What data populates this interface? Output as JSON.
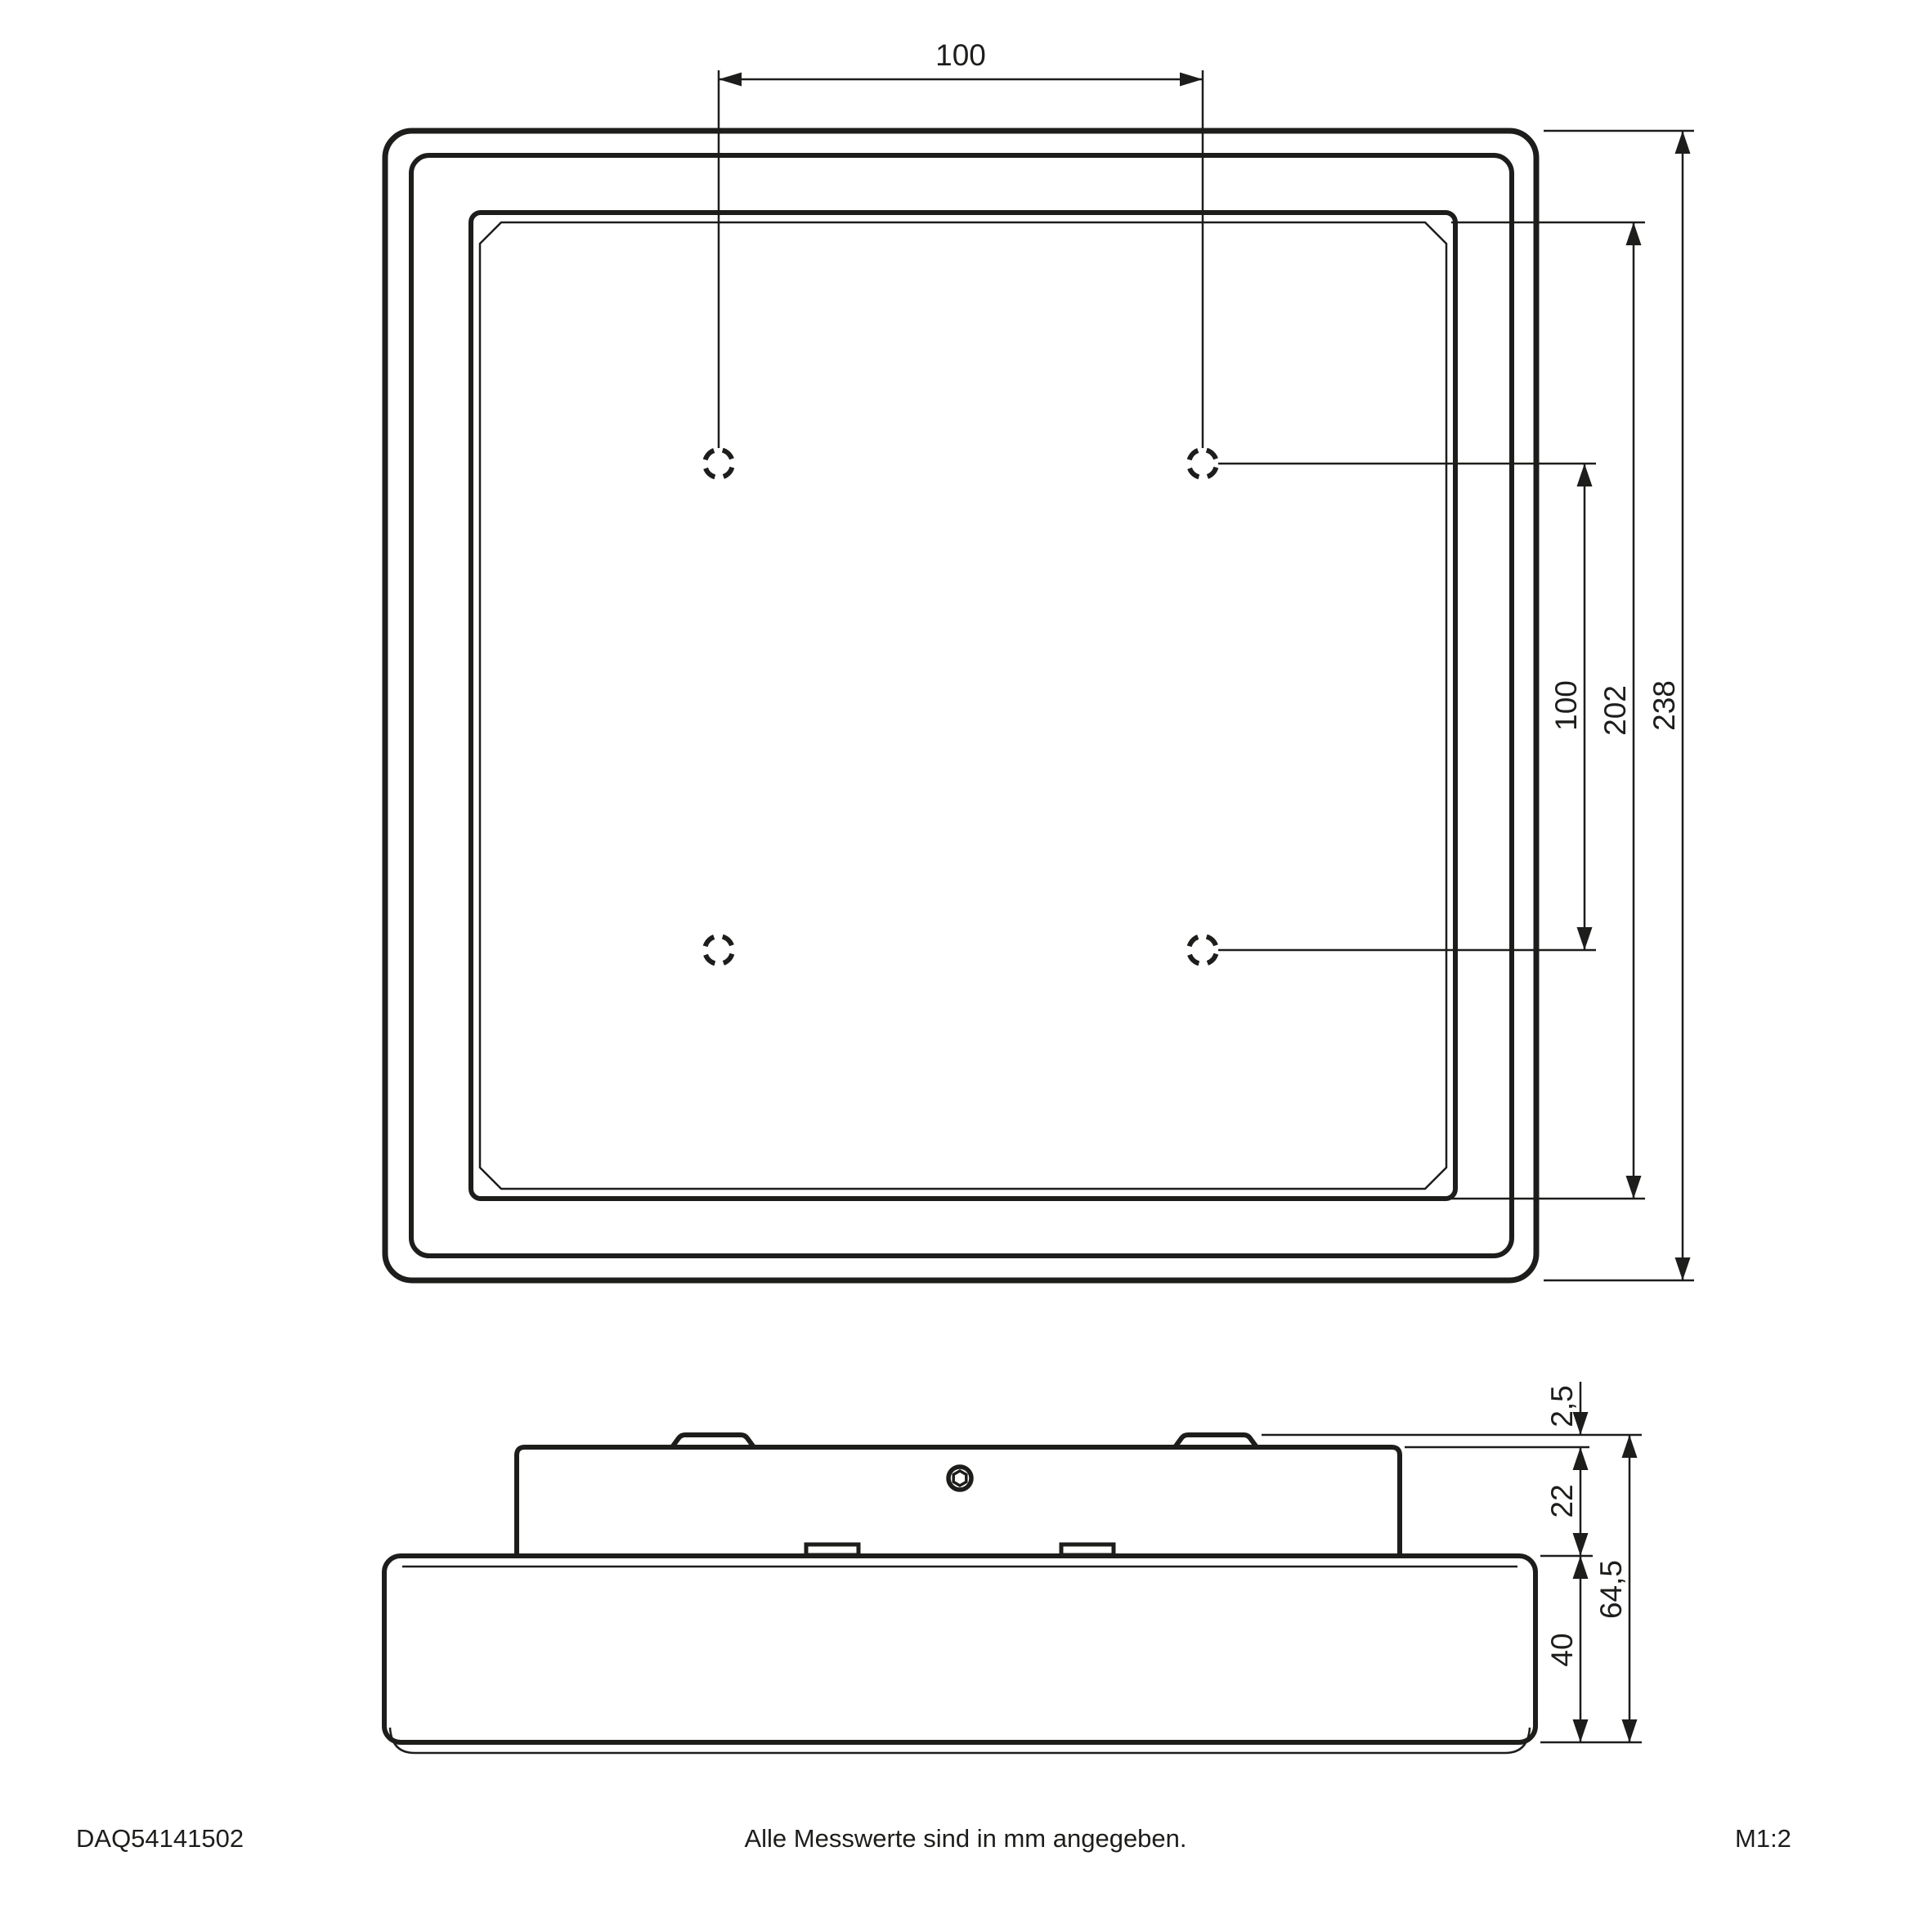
{
  "drawing": {
    "units_note": "Alle Messwerte sind in mm angegeben.",
    "document_number": "DAQ54141502",
    "scale_label": "M1:2",
    "line_color": "#1d1d1b",
    "background_color": "#ffffff"
  },
  "top_view": {
    "dim_hole_spacing_horizontal": "100",
    "dim_hole_spacing_vertical": "100",
    "dim_inner_panel": "202",
    "dim_outer_frame": "238",
    "mounting_hole_count": "4"
  },
  "side_view": {
    "dim_clip_protrusion": "2,5",
    "dim_housing_height": "22",
    "dim_diffuser_height": "40",
    "dim_total_height": "64,5"
  }
}
